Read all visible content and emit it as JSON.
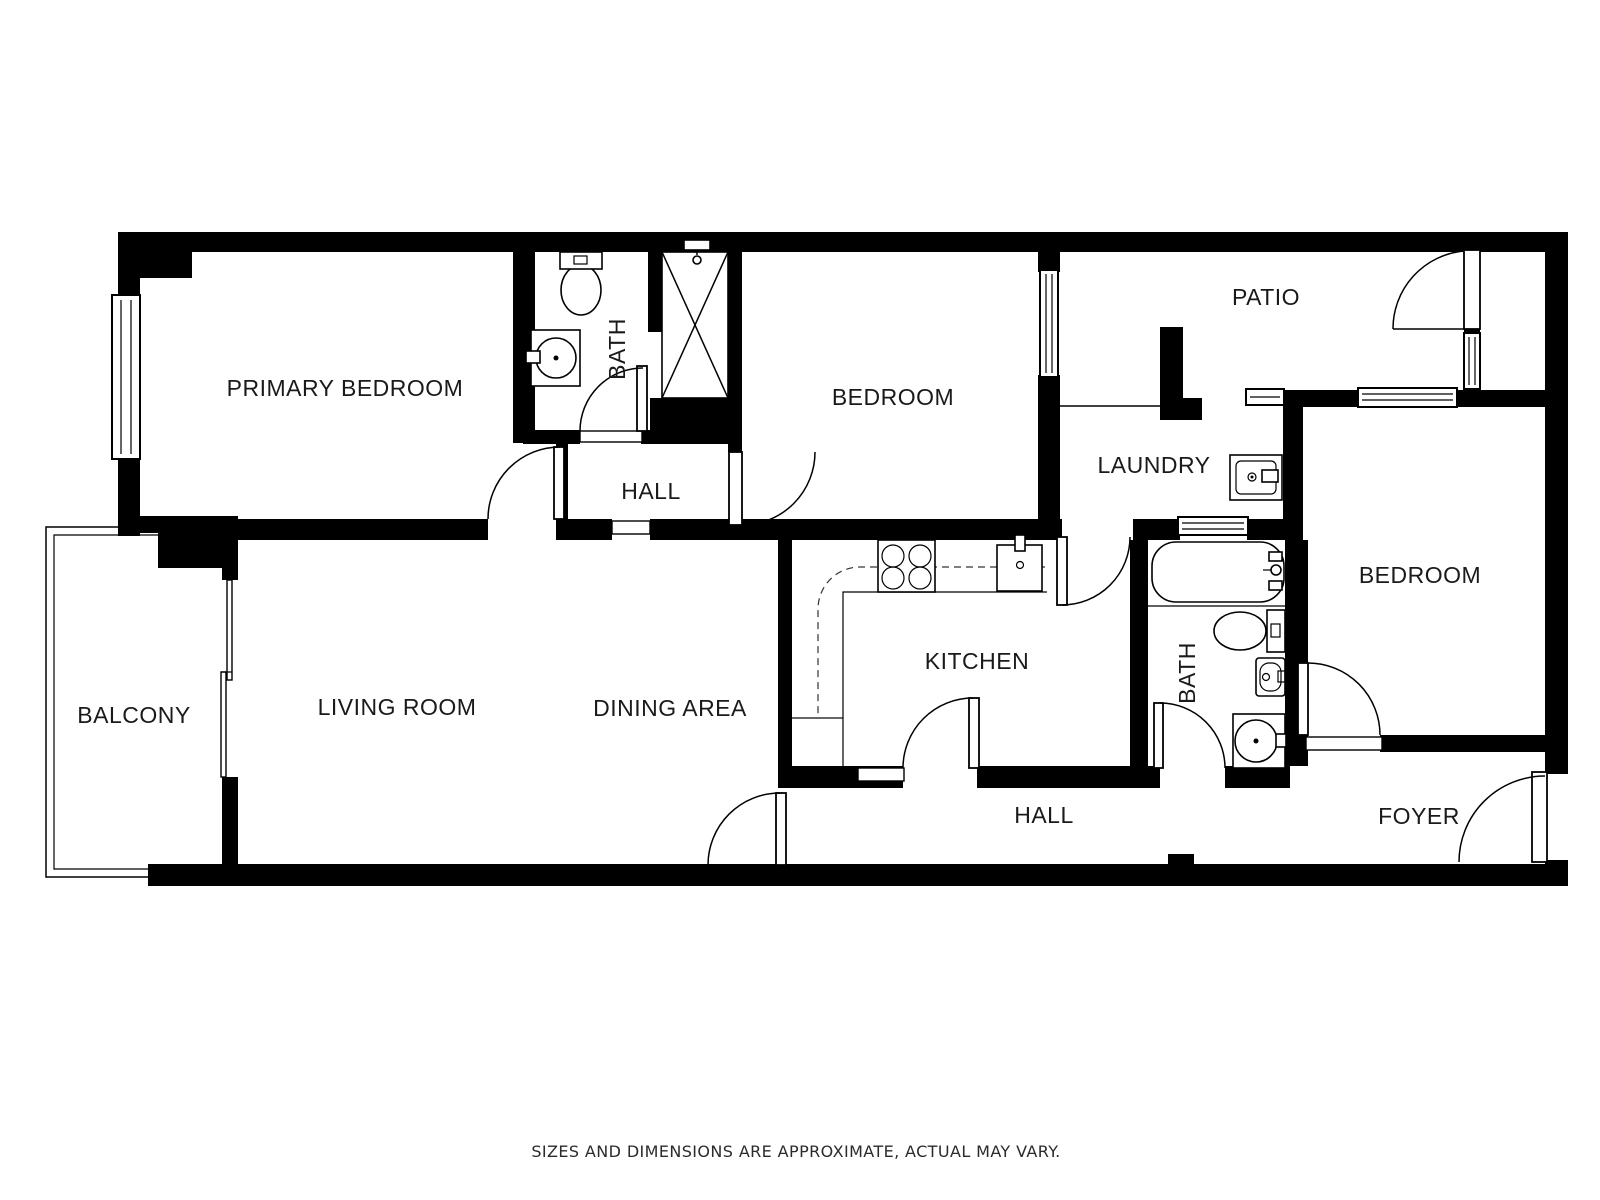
{
  "floor_plan": {
    "labels": {
      "primary_bedroom": "PRIMARY BEDROOM",
      "bath_top": "BATH",
      "hall_middle": "HALL",
      "bedroom_middle": "BEDROOM",
      "patio": "PATIO",
      "laundry": "LAUNDRY",
      "bedroom_right": "BEDROOM",
      "bath_right": "BATH",
      "kitchen": "KITCHEN",
      "living_room": "LIVING ROOM",
      "dining_area": "DINING AREA",
      "balcony": "BALCONY",
      "hall_bottom": "HALL",
      "foyer": "FOYER"
    },
    "disclaimer": "SIZES AND DIMENSIONS ARE APPROXIMATE, ACTUAL MAY VARY.",
    "colors": {
      "wall": "#000000",
      "background": "#ffffff",
      "label_text": "#1a1a1a"
    }
  }
}
